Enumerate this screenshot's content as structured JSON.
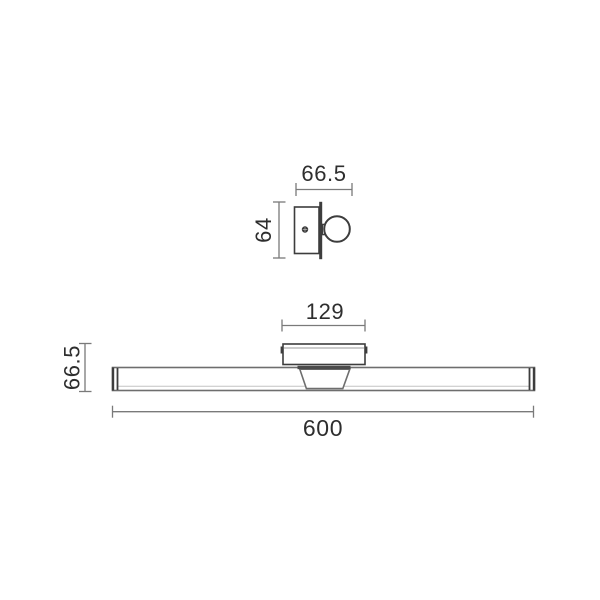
{
  "drawing": {
    "kind": "wall-light-dimension-drawing",
    "views": {
      "side_view": {
        "depth_label": "66.5",
        "height_label": "64"
      },
      "front_view": {
        "bracket_width_label": "129",
        "height_label": "66.5",
        "length_label": "600"
      }
    },
    "colors": {
      "background": "#ffffff",
      "outline_dark": "#3d3d3d",
      "outline_gray": "#6e6e6e",
      "dimension_line": "#7a7a7a",
      "text": "#2e2e2e",
      "highlight_line": "#c4c4c4"
    }
  }
}
